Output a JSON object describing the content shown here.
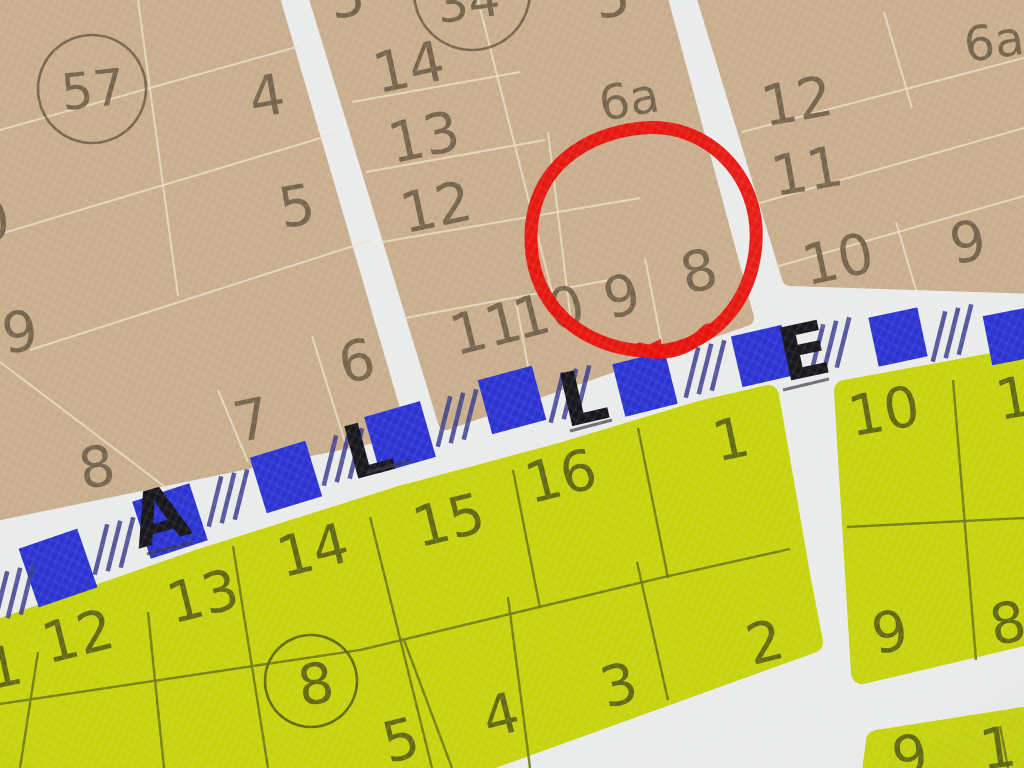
{
  "colors": {
    "tan_block": "#c9ae8d",
    "yellow_block": "#c6d30d",
    "street_white": "#eaeceb",
    "square_blue": "#2b34d2",
    "hatch_navy": "#3b3f8f",
    "letter_black": "#17171d",
    "annotation_red": "#e7130d",
    "tan_number": "#6b5c45",
    "yellow_number": "#596014"
  },
  "street": {
    "letters": [
      "A",
      "L",
      "L",
      "E"
    ]
  },
  "annotation": {
    "type": "hand-drawn-circle"
  },
  "blocks": {
    "tan_left": {
      "block_number": "57",
      "parcels": [
        "4",
        "5",
        "9",
        "8",
        "7",
        "6",
        "0"
      ]
    },
    "tan_middle": {
      "block_number": "34",
      "parcels": [
        "5",
        "14",
        "13",
        "12",
        "6a",
        "11",
        "10",
        "9",
        "8",
        "5"
      ]
    },
    "tan_right": {
      "parcels": [
        "6a",
        "12",
        "11",
        "10",
        "9"
      ]
    },
    "yellow_main": {
      "block_number": "8",
      "parcels": [
        "1",
        "12",
        "13",
        "14",
        "15",
        "16",
        "1",
        "5",
        "4",
        "3",
        "2"
      ]
    },
    "yellow_right": {
      "parcels": [
        "10",
        "1",
        "9",
        "8"
      ]
    },
    "yellow_bottom": {
      "parcels": [
        "9",
        "1"
      ]
    }
  }
}
